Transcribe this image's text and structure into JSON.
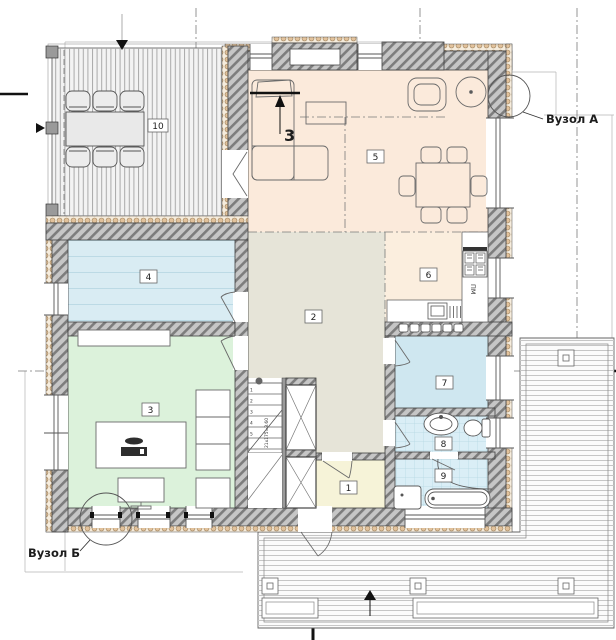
{
  "plan": {
    "labels": {
      "node_a": "Вузол А",
      "node_b": "Вузол Б",
      "section_marker": "3",
      "dishwasher": "ПМ",
      "stair_formula": "21х175=3.60"
    },
    "rooms": {
      "r1": "1",
      "r2": "2",
      "r3": "3",
      "r4": "4",
      "r5": "5",
      "r6": "6",
      "r7": "7",
      "r8": "8",
      "r9": "9",
      "r10": "10"
    },
    "stair_steps": [
      "1",
      "2",
      "3",
      "4",
      "5"
    ],
    "colors": {
      "wall": "#c6c6c6",
      "wall_hatch_line": "#7d7d7d",
      "insulation": "#e2c29c",
      "room_living": "#fbeadb",
      "room_kitchen": "#fbeede",
      "room_hall": "#e6e4d8",
      "room_office": "#dcf2db",
      "room_utility": "#d9ecf3",
      "room_bedroom": "#cfe7f0",
      "room_bath": "#daeef6",
      "room_entry": "#f6f3d8",
      "terrace": "#f3f3f3",
      "deck": "#fbfbfb"
    }
  }
}
